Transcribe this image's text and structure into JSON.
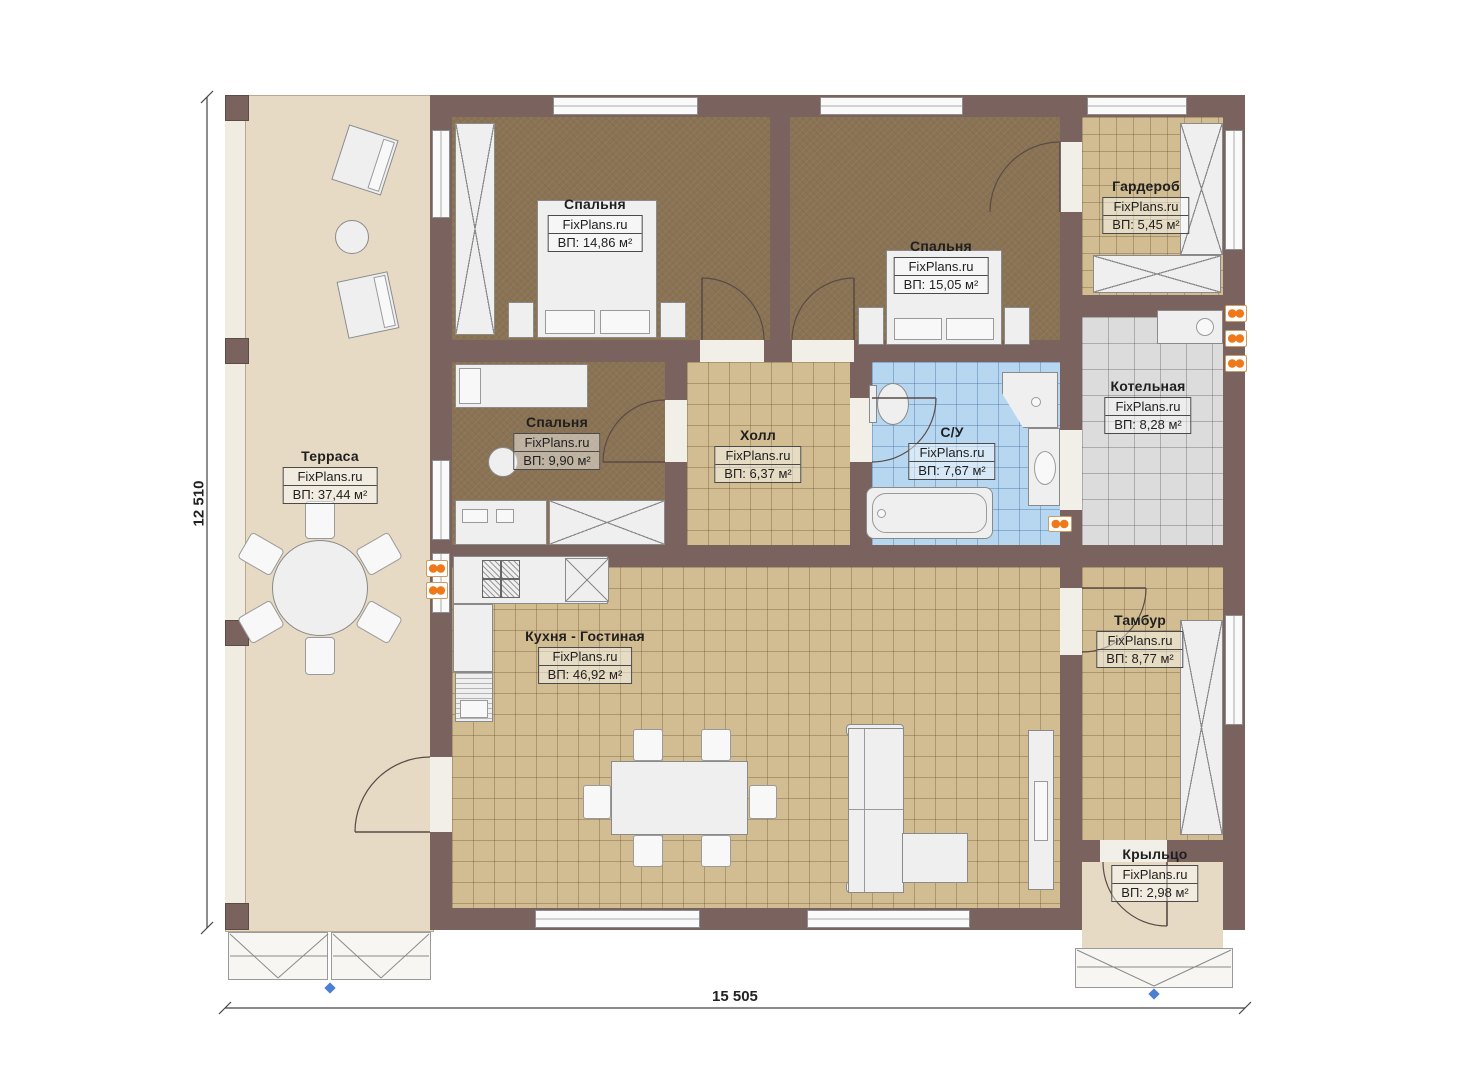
{
  "plan": {
    "brand": "FixPlans.ru",
    "dimensions": {
      "height": "12 510",
      "width": "15 505"
    },
    "rooms": {
      "terrace": {
        "name": "Терраса",
        "area": "ВП: 37,44 м²"
      },
      "bedroom1": {
        "name": "Спальня",
        "area": "ВП: 14,86 м²"
      },
      "bedroom2": {
        "name": "Спальня",
        "area": "ВП: 15,05 м²"
      },
      "wardrobe": {
        "name": "Гардероб",
        "area": "ВП: 5,45 м²"
      },
      "boiler_room": {
        "name": "Котельная",
        "area": "ВП: 8,28 м²"
      },
      "bedroom3": {
        "name": "Спальня",
        "area": "ВП: 9,90 м²"
      },
      "hall": {
        "name": "Холл",
        "area": "ВП: 6,37 м²"
      },
      "bathroom": {
        "name": "С/У",
        "area": "ВП: 7,67 м²"
      },
      "kitchen_living": {
        "name": "Кухня - Гостиная",
        "area": "ВП: 46,92 м²"
      },
      "tambour": {
        "name": "Тамбур",
        "area": "ВП: 8,77 м²"
      },
      "porch": {
        "name": "Крыльцо",
        "area": "ВП: 2,98 м²"
      }
    },
    "colors": {
      "wall": "#7a625f",
      "floor_dark": "#8a7354",
      "tile_tan": "#d2bd92",
      "tile_gray": "#dcdcdc",
      "tile_blue": "#b7d7f1",
      "terrace": "#e7dac5",
      "radiator": "#f07818",
      "marker": "#4a7fd4"
    }
  }
}
